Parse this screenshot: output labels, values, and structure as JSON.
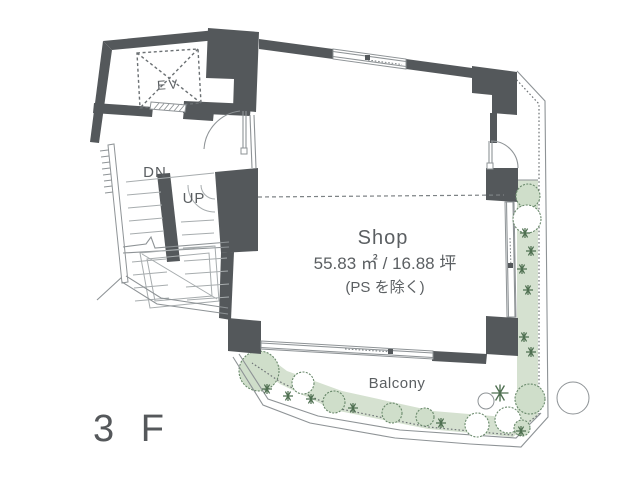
{
  "floor_plan": {
    "floor_label": "3 F",
    "elevator": {
      "label": "EV"
    },
    "stairs": {
      "down_label": "DN",
      "up_label": "UP"
    },
    "shop": {
      "name": "Shop",
      "area": "55.83 ㎡ / 16.88 坪",
      "area_note": "(PS を除く)"
    },
    "balcony": {
      "label": "Balcony"
    },
    "colors": {
      "wall": "#54585b",
      "outline": "#8e9396",
      "tread_line": "#a7acae",
      "planting_fill": "#d5e1d0",
      "planting_line": "#68886a",
      "text": "#5b5f62"
    }
  }
}
